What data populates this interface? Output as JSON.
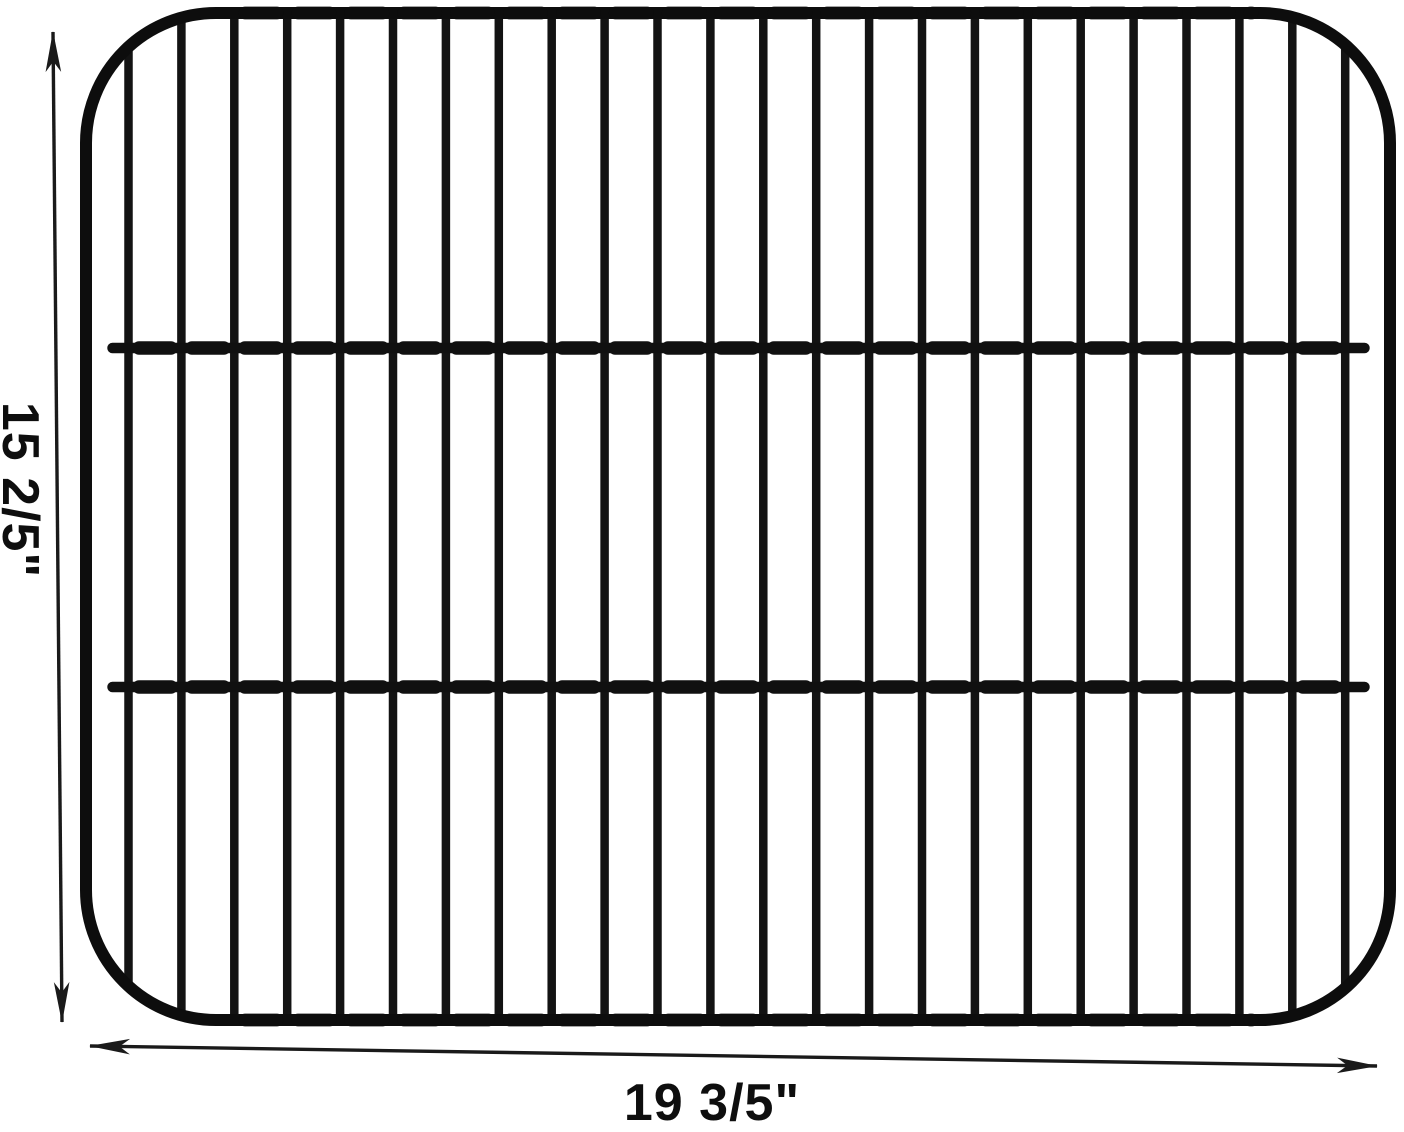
{
  "image": {
    "subject": "wire-cooking-grate-with-dimensions"
  },
  "dimension_labels": {
    "height": "15 2/5\"",
    "width": "19 3/5\""
  },
  "grate": {
    "vertical_wire_count": 24,
    "crossbar_count": 2
  },
  "icons": {
    "height_arrow": "vertical-double-headed-arrow",
    "width_arrow": "horizontal-double-headed-arrow"
  },
  "colors": {
    "wire": "#131313",
    "frame": "#0d0d0d",
    "crossbar": "#101010",
    "dimension_line": "#1a1a1a",
    "background": "#ffffff"
  }
}
